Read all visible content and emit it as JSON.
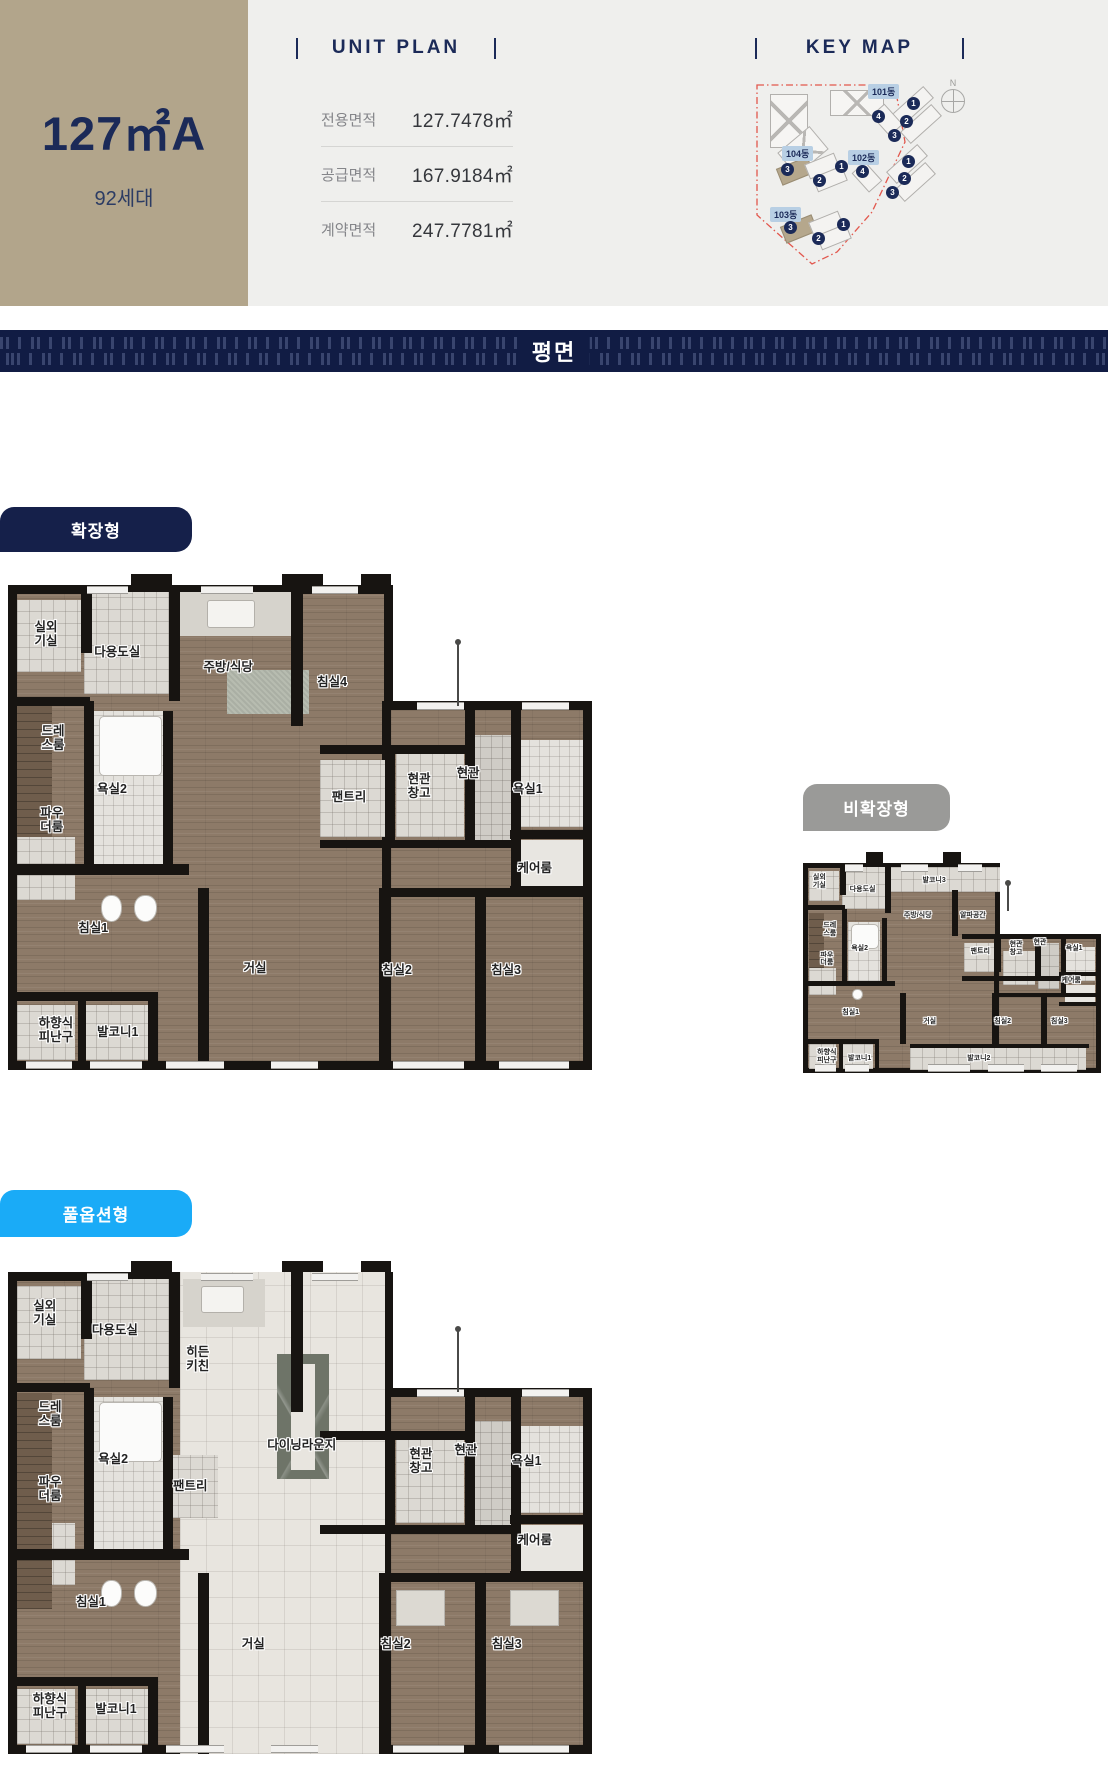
{
  "header": {
    "unit_name": "127㎡A",
    "unit_households": "92세대",
    "unit_plan": {
      "title": "UNIT PLAN",
      "rows": [
        {
          "label": "전용면적",
          "value": "127.7478㎡"
        },
        {
          "label": "공급면적",
          "value": "167.9184㎡"
        },
        {
          "label": "계약면적",
          "value": "247.7781㎡"
        }
      ]
    },
    "key_map": {
      "title": "KEY MAP",
      "compass": "N",
      "buildings": [
        {
          "name": "101동",
          "units": [
            "1",
            "4",
            "2",
            "3"
          ],
          "highlighted": []
        },
        {
          "name": "104동",
          "units": [
            "3",
            "1",
            "2"
          ],
          "highlighted": [
            "3"
          ]
        },
        {
          "name": "102동",
          "units": [
            "1",
            "4",
            "2",
            "3"
          ],
          "highlighted": []
        },
        {
          "name": "103동",
          "units": [
            "3",
            "1",
            "2"
          ],
          "highlighted": [
            "3"
          ]
        }
      ]
    }
  },
  "banner": {
    "title": "평면"
  },
  "colors": {
    "tan": "#b2a58b",
    "navy": "#1b2a58",
    "label_navy": "#15204a",
    "label_gray": "#9a9a98",
    "label_cyan": "#1aabf7",
    "boundary_red": "#e2574d"
  },
  "plans": [
    {
      "label": "확장형",
      "rooms": [
        {
          "name": "실외\n기실",
          "x": 6.5,
          "y": 10
        },
        {
          "name": "다용도실",
          "x": 18.7,
          "y": 13.8
        },
        {
          "name": "주방/식당",
          "x": 37.7,
          "y": 17
        },
        {
          "name": "침실4",
          "x": 55.5,
          "y": 20
        },
        {
          "name": "드레\n스룸",
          "x": 7.7,
          "y": 31.5
        },
        {
          "name": "욕실2",
          "x": 17.8,
          "y": 42
        },
        {
          "name": "파우\n더룸",
          "x": 7.5,
          "y": 48.5
        },
        {
          "name": "팬트리",
          "x": 58.4,
          "y": 43.7
        },
        {
          "name": "현관\n창고",
          "x": 70.4,
          "y": 41.4
        },
        {
          "name": "현관",
          "x": 78.8,
          "y": 38.8
        },
        {
          "name": "욕실1",
          "x": 89,
          "y": 42
        },
        {
          "name": "케어룸",
          "x": 90.2,
          "y": 58.4
        },
        {
          "name": "침실1",
          "x": 14.6,
          "y": 70.7
        },
        {
          "name": "거실",
          "x": 42.3,
          "y": 79
        },
        {
          "name": "침실2",
          "x": 66.6,
          "y": 79.4
        },
        {
          "name": "침실3",
          "x": 85.3,
          "y": 79.4
        },
        {
          "name": "하향식\n피난구",
          "x": 8.2,
          "y": 91.8
        },
        {
          "name": "발코니1",
          "x": 18.8,
          "y": 92.2
        }
      ]
    },
    {
      "label": "비확장형",
      "rooms": [
        {
          "name": "실외\n기실",
          "x": 5.5,
          "y": 9
        },
        {
          "name": "다용도실",
          "x": 20,
          "y": 13
        },
        {
          "name": "발코니3",
          "x": 44,
          "y": 8.5
        },
        {
          "name": "주방/식당",
          "x": 38.5,
          "y": 25
        },
        {
          "name": "알파공간",
          "x": 57,
          "y": 25
        },
        {
          "name": "드레\n스룸",
          "x": 9,
          "y": 32
        },
        {
          "name": "욕실2",
          "x": 19,
          "y": 41
        },
        {
          "name": "파우\n더룸",
          "x": 8,
          "y": 46
        },
        {
          "name": "팬트리",
          "x": 59.5,
          "y": 42.5
        },
        {
          "name": "현관\n창고",
          "x": 71.5,
          "y": 41
        },
        {
          "name": "현관",
          "x": 79.5,
          "y": 38
        },
        {
          "name": "욕실1",
          "x": 91,
          "y": 41
        },
        {
          "name": "케어룸",
          "x": 90,
          "y": 56
        },
        {
          "name": "침실1",
          "x": 16,
          "y": 71.5
        },
        {
          "name": "거실",
          "x": 42.5,
          "y": 75.5
        },
        {
          "name": "침실2",
          "x": 67,
          "y": 75.5
        },
        {
          "name": "침실3",
          "x": 86,
          "y": 75.5
        },
        {
          "name": "하향식\n피난구",
          "x": 8,
          "y": 92.5
        },
        {
          "name": "발코니1",
          "x": 19,
          "y": 93.5
        },
        {
          "name": "발코니2",
          "x": 59,
          "y": 93.5
        }
      ]
    },
    {
      "label": "풀옵션형",
      "rooms": [
        {
          "name": "실외\n기실",
          "x": 6.3,
          "y": 8.5
        },
        {
          "name": "다용도실",
          "x": 18.3,
          "y": 12
        },
        {
          "name": "히든\n키친",
          "x": 32.5,
          "y": 18
        },
        {
          "name": "다이닝라운지",
          "x": 50.3,
          "y": 35.8
        },
        {
          "name": "드레\n스룸",
          "x": 7.2,
          "y": 29.4
        },
        {
          "name": "욕실2",
          "x": 18,
          "y": 38.9
        },
        {
          "name": "파우\n더룸",
          "x": 7.2,
          "y": 45.1
        },
        {
          "name": "팬트리",
          "x": 31.2,
          "y": 44.3
        },
        {
          "name": "현관\n창고",
          "x": 70.7,
          "y": 39.3
        },
        {
          "name": "현관",
          "x": 78.4,
          "y": 36.9
        },
        {
          "name": "욕실1",
          "x": 88.8,
          "y": 39.3
        },
        {
          "name": "케어룸",
          "x": 90.2,
          "y": 55.5
        },
        {
          "name": "침실1",
          "x": 14.2,
          "y": 68.5
        },
        {
          "name": "거실",
          "x": 42,
          "y": 77.2
        },
        {
          "name": "침실2",
          "x": 66.4,
          "y": 77.2
        },
        {
          "name": "침실3",
          "x": 85.4,
          "y": 77.2
        },
        {
          "name": "하향식\n피난구",
          "x": 7.2,
          "y": 90
        },
        {
          "name": "발코니1",
          "x": 18.5,
          "y": 90.7
        }
      ]
    }
  ]
}
